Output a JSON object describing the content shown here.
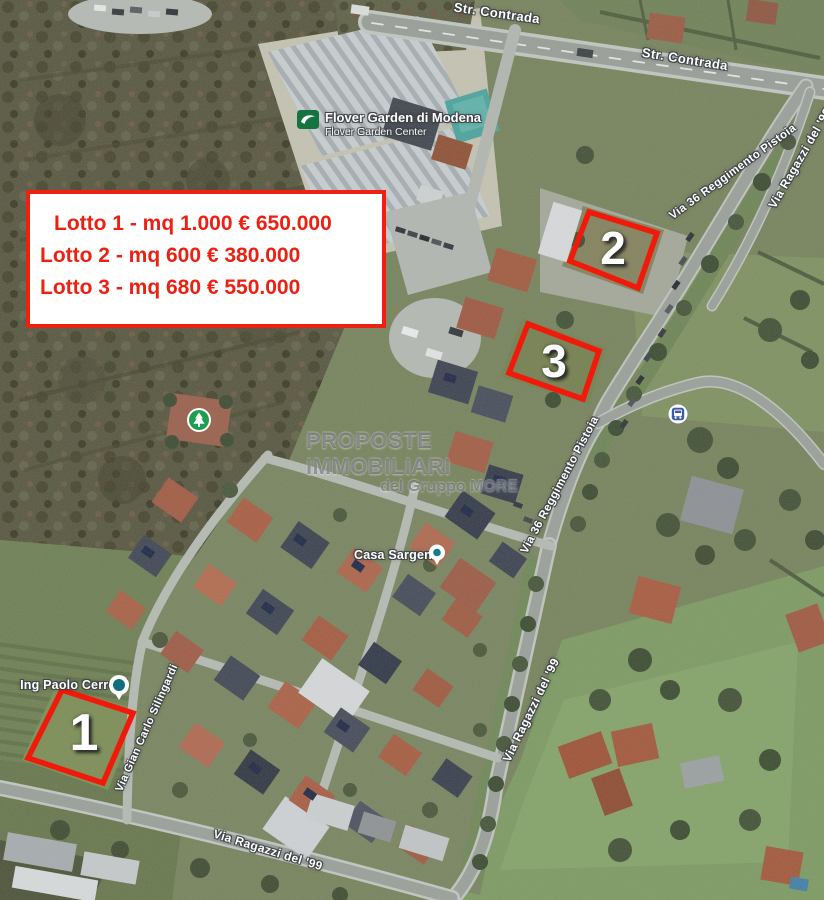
{
  "info_box": {
    "lines": [
      "Lotto 1 - mq 1.000 € 650.000",
      "Lotto 2 - mq 600 € 380.000",
      "Lotto 3 - mq 680 € 550.000"
    ]
  },
  "lots": [
    {
      "number": "1"
    },
    {
      "number": "2"
    },
    {
      "number": "3"
    }
  ],
  "streets": {
    "contrada": "Str. Contrada",
    "reggimento_pistoia": "Via 36 Reggimento Pistoia",
    "ragazzi_99": "Via Ragazzi del '99",
    "silingardi": "Via Gian Carlo Silingardi"
  },
  "places": {
    "flover": {
      "title": "Flover Garden di Modena",
      "subtitle": "Flover Garden Center"
    },
    "casa_sargenti": {
      "label": "Casa Sargenti"
    },
    "cerretti": {
      "label": "Ing Paolo Cerretti"
    }
  },
  "watermark": {
    "line1": "PROPOSTE IMMOBILIARI",
    "line2": "del Gruppo MORE"
  },
  "colors": {
    "accent_red": "#ee2012",
    "lot_outline_red": "#f0190a",
    "road_label_white": "#ffffff",
    "watermark_gray": "#4e545c",
    "flover_green": "#15733f",
    "park_green": "#1e9e50",
    "pin_teal": "#0f7f8d",
    "transit_blue": "#3d5ba9"
  }
}
